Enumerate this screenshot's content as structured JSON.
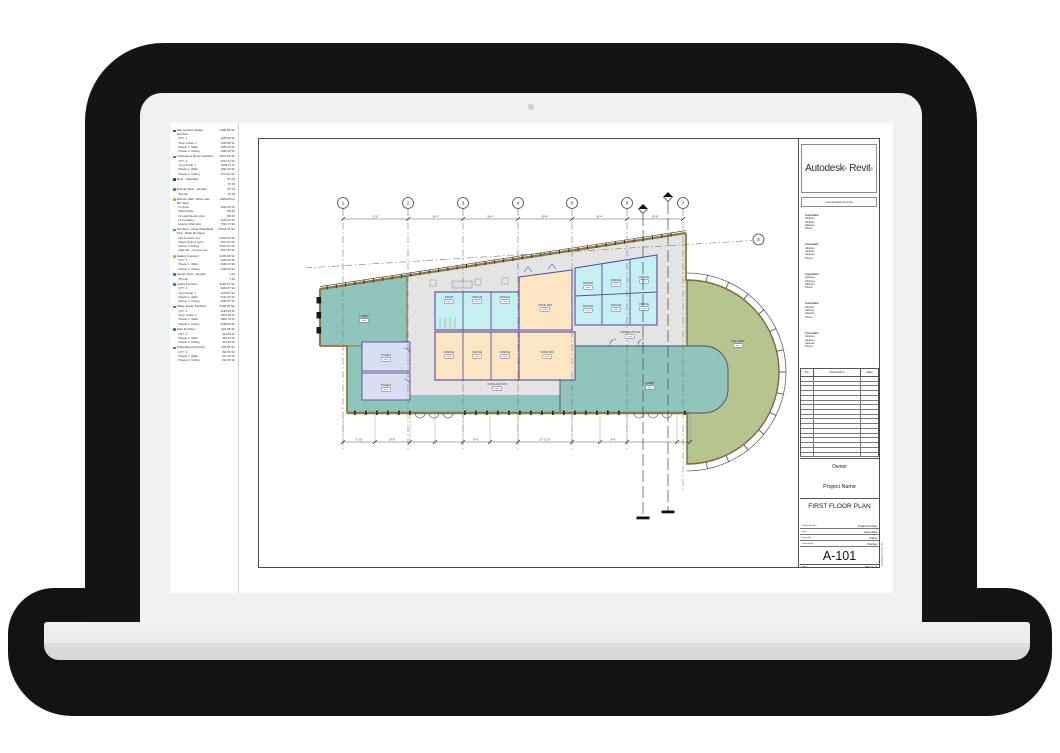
{
  "sheet": {
    "logo_word1": "Autodesk",
    "logo_word2": "Revit",
    "url": "www.autodesk.com/revit",
    "consultant_block": [
      "Consultant",
      "Address",
      "Address",
      "Address",
      "Phone"
    ],
    "revision": {
      "no": "No.",
      "description": "Description",
      "date": "Date",
      "empty_rows": 17
    },
    "owner": "Owner",
    "project_name": "Project Name",
    "view_title": "FIRST FLOOR PLAN",
    "fields": [
      {
        "label": "Project Number",
        "value": "Project Number"
      },
      {
        "label": "Date",
        "value": "Issue Date"
      },
      {
        "label": "Drawn By",
        "value": "Author"
      },
      {
        "label": "Checked By",
        "value": "Checker"
      }
    ],
    "sheet_number": "A-101",
    "scale_label": "Scale",
    "scale_value": "1/8\" = 1'-0\"",
    "print_stamp": "6/23/2015 2:57:21 PM"
  },
  "schedule": {
    "groups": [
      {
        "icon_color": "#3a3a3a",
        "name": "Site Lambert Space Function",
        "value": "1286.68 SF",
        "rows": [
          [
            "QTY: 2",
            "1286.68 SF"
          ],
          [
            "Shop Grade: 1",
            "1256.80 SF"
          ],
          [
            "Plaster 1: Walls",
            "1089.28 SF"
          ],
          [
            "Plaster 2: Ceiling",
            "1286.68 SF"
          ]
        ]
      },
      {
        "icon_color": "#5b4a9b",
        "name": "Conference Room Function",
        "value": "2072.52 SF",
        "rows": [
          [
            "QTY: 2",
            "2072.52 SF"
          ],
          [
            "Vinyl Grade: 1",
            "1868.14 LF"
          ],
          [
            "Plaster 1: Walls",
            "1890.30 SF"
          ],
          [
            "Plaster 2: Ceiling",
            "2072.52 SF"
          ]
        ]
      },
      {
        "icon_color": "#2b2b2b",
        "name": "Door - Standard",
        "value": "87.00",
        "rows": [
          [
            "",
            "87.00"
          ]
        ]
      },
      {
        "icon_color": "#2e7d7d",
        "name": "Exterior Door - Double",
        "value": "87.00",
        "rows": [
          [
            "88 total",
            "87.00"
          ]
        ]
      },
      {
        "icon_color": "#c8a020",
        "name": "Exterior Wall - Brick over Mtl. Stud",
        "value": "2480.05 LF",
        "rows": [
          [
            "LF Brick",
            "4629.06 SF"
          ],
          [
            "Metal Studs",
            "239.00"
          ],
          [
            "Drywall (interior side)",
            "436.00"
          ],
          [
            "LF Insulation",
            "4629.06 SF"
          ],
          [
            "Exterior Wall paint",
            "7631.70 SF"
          ]
        ]
      },
      {
        "icon_color": "#2e7d7d",
        "name": "Furniture - Desk (Standard) Two - Work Furniture",
        "value": "37944.00 SF",
        "rows": [
          [
            "Net Furniture Top",
            "37944.00 SF"
          ],
          [
            "Metal furniture paint",
            "3817.80 SF"
          ],
          [
            "Plaster 2 Setting",
            "37944.00 SF"
          ],
          [
            "Matt Tab - console runs",
            "3817.80 SF"
          ]
        ]
      },
      {
        "icon_color": "#c8a020",
        "name": "Gallery Function",
        "value": "2436.00 SF",
        "rows": [
          [
            "QTY: 2",
            "2436.00 SF"
          ],
          [
            "Plaster 1: Walls",
            "2436.00 SF"
          ],
          [
            "Plaster 2: Ceiling",
            "2436.00 SF"
          ]
        ]
      },
      {
        "icon_color": "#3b5fa0",
        "name": "Interior Door - Double",
        "value": "1.00",
        "rows": [
          [
            "88 total",
            "1.00"
          ]
        ]
      },
      {
        "icon_color": "#2e7d7d",
        "name": "Lobby Function",
        "value": "3282.87 SF",
        "rows": [
          [
            "QTY: 4",
            "3282.87 SF"
          ],
          [
            "Vinyl Grade: 1",
            "3164.87 SF"
          ],
          [
            "Plaster 1: Walls",
            "3162.30 SF"
          ],
          [
            "Plaster 2: Ceiling",
            "3282.87 SF"
          ]
        ]
      },
      {
        "icon_color": "#5b4a9b",
        "name": "Office Space Function",
        "value": "4188.08 SF",
        "rows": [
          [
            "QTY: 9",
            "4188.08 SF"
          ],
          [
            "Shop Grade: 1",
            "3944.25 LF"
          ],
          [
            "Plaster 1: Walls",
            "3806.70 SF"
          ],
          [
            "Plaster 2: Ceiling",
            "4188.08 SF"
          ]
        ]
      },
      {
        "icon_color": "#2e7d7d",
        "name": "Stair Function",
        "value": "404.08 SF",
        "rows": [
          [
            "QTY: 2",
            "404.08 SF"
          ],
          [
            "Plaster 1: Walls",
            "386.40 SF"
          ],
          [
            "Plaster 2: Ceiling",
            "404.08 SF"
          ]
        ]
      },
      {
        "icon_color": "#5b4a9b",
        "name": "Toilet Room Function",
        "value": "392.55 SF",
        "rows": [
          [
            "QTY: 2",
            "392.55 SF"
          ],
          [
            "Plaster 1: Walls",
            "371.10 SF"
          ],
          [
            "Plaster 2: Ceiling",
            "392.55 SF"
          ]
        ]
      }
    ]
  },
  "plan": {
    "grid_labels": [
      "1",
      "2",
      "3",
      "4",
      "5",
      "6",
      "7"
    ],
    "diag_grid_label": "8",
    "rooms": {
      "stair": "STAIR",
      "office": "OFFICE",
      "conf": "CONF RM",
      "toilet": "TOILET",
      "lobby": "LOBBY",
      "gallery": "GALLERY",
      "circulation": "CIRCULATION"
    },
    "dims_top": [
      "21'-8\"",
      "18'-4\"",
      "18'-4\"",
      "18'-4\"",
      "18'-4\"",
      "18'-8\""
    ],
    "dim_bottom_main": "27'-5 1/8\"",
    "dims_bottom_small": [
      "9'-10\"",
      "10'-8\"",
      "8'-4\"",
      "8'-4\""
    ],
    "colors": {
      "teal_room": "#8fc5bd",
      "cyan_room": "#c6eff1",
      "tan_room": "#fbe6c4",
      "lavender_room": "#d7dff0",
      "gallery_green": "#b6c58f",
      "circulation_gray": "#e4e4e4",
      "partition_purple": "#5b4a9b",
      "ext_wall": "#8a7a40"
    }
  }
}
